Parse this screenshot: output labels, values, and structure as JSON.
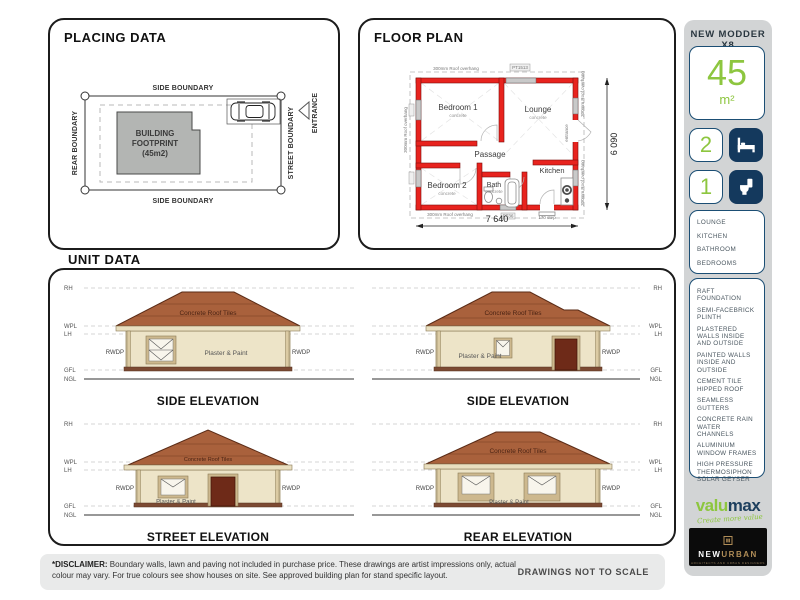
{
  "placing": {
    "title": "PLACING DATA",
    "side_boundary_top": "SIDE BOUNDARY",
    "side_boundary_bottom": "SIDE BOUNDARY",
    "rear_boundary": "REAR BOUNDARY",
    "street_boundary": "STREET BOUNDARY",
    "entrance": "ENTRANCE",
    "footprint_line1": "BUILDING",
    "footprint_line2": "FOOTPRINT",
    "footprint_line3": "(45m2)"
  },
  "floorplan": {
    "title": "FLOOR PLAN",
    "bedroom1": "Bedroom 1",
    "bedroom2": "Bedroom 2",
    "lounge": "Lounge",
    "passage": "Passage",
    "bath": "Bath",
    "kitchen": "Kitchen",
    "concrete": "concrete",
    "width_dim": "7 640",
    "height_dim": "6 090",
    "overhang": "300mm Roof overhang",
    "step_label": "170 step",
    "entrance_label": "entrance",
    "window_tag_top": "PT1513",
    "window_tag_bottom": "PT36"
  },
  "unit": {
    "title": "UNIT DATA",
    "roof_label": "Concrete Roof Tiles",
    "wall_label": "Plaster & Paint",
    "rwdp": "RWDP",
    "levels": [
      "RH",
      "WPL",
      "LH",
      "GFL",
      "NGL"
    ],
    "captions": [
      "SIDE ELEVATION",
      "SIDE ELEVATION",
      "STREET ELEVATION",
      "REAR ELEVATION"
    ]
  },
  "sidebar": {
    "title": "NEW MODDER X8",
    "area_value": "45",
    "area_unit": "m²",
    "bedroom_count": "2",
    "bathroom_count": "1",
    "rooms": [
      "LOUNGE",
      "KITCHEN",
      "BATHROOM",
      "BEDROOMS"
    ],
    "features": [
      "RAFT FOUNDATION",
      "SEMI-FACEBRICK PLINTH",
      "PLASTERED WALLS INSIDE AND OUTSIDE",
      "PAINTED WALLS INSIDE AND OUTSIDE",
      "CEMENT TILE HIPPED ROOF",
      "SEAMLESS GUTTERS",
      "CONCRETE RAIN WATER CHANNELS",
      "ALUMINIUM WINDOW FRAMES",
      "HIGH PRESSURE THERMOSIPHON SOLAR GEYSER"
    ],
    "valumax_left": "valu",
    "valumax_right": "max",
    "valumax_tagline": "Create more value",
    "newurban_left": "NEW",
    "newurban_right": "URBAN",
    "newurban_sub": "ARCHITECTS AND URBAN DESIGNERS"
  },
  "footer": {
    "disclaimer_label": "*DISCLAIMER:",
    "disclaimer_text": "Boundary walls, lawn and paving not included in purchase price. These drawings are artist impressions only, actual colour may vary. For true colours see show houses on site. See approved building plan for stand specific layout.",
    "not_to_scale": "DRAWINGS NOT TO SCALE"
  },
  "colors": {
    "accent_green": "#8dc63f",
    "navy": "#1b4e74",
    "dark_navy": "#14395d",
    "wall_red": "#e8231e",
    "roof_brown": "#a9613c",
    "cream": "#ede4c8",
    "sidebar_gray": "#d2d4d5",
    "footprint_gray": "#b3b5b3",
    "bronze": "#b08d57"
  },
  "icons": {
    "bedrooms": "bed-icon",
    "bathrooms": "toilet-icon",
    "parking": "car-icon",
    "entrance": "entrance-arrow-icon",
    "brand_mark": "newurban-mark-icon"
  }
}
